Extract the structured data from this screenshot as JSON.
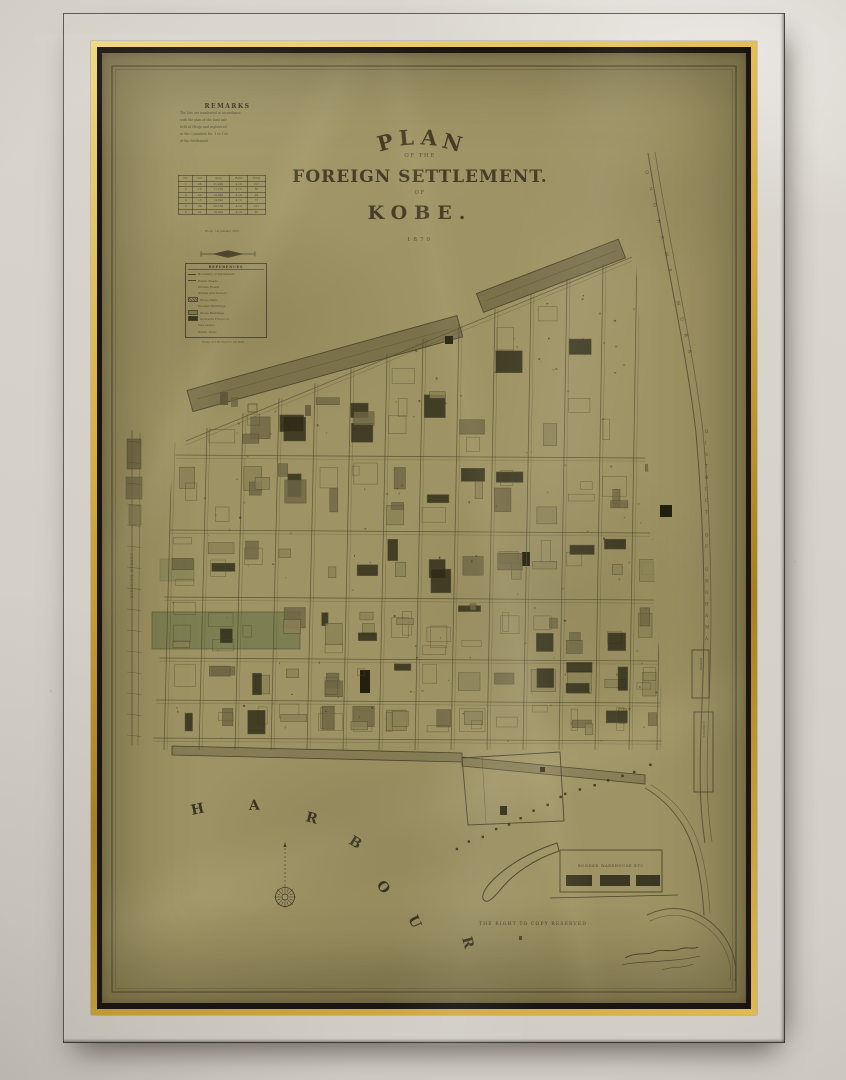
{
  "scene": {
    "wall_color": "#d8d4cc",
    "frame_color": "#46302a",
    "gold_color": "#d8ac3c",
    "paper_color": "#9e9364",
    "ink_color": "#3e3826"
  },
  "map": {
    "title": {
      "arc_letters": [
        "P",
        "L",
        "A",
        "N"
      ],
      "of_the": "OF THE",
      "main": "FOREIGN SETTLEMENT.",
      "of": "OF",
      "city": "KOBE.",
      "year": "1870"
    },
    "remarks": {
      "heading": "REMARKS",
      "lines": [
        "The lots are numbered in accordance",
        "with the plan of the land sale",
        "held at Hiogo and registered",
        "at the Consulate    No. 1 to 126",
        "of  the  Settlement"
      ]
    },
    "table": {
      "headers": [
        "No.",
        "Lot",
        "Area",
        "Rent",
        "Total"
      ],
      "rows": [
        [
          "1",
          "26",
          "21,400",
          "4.10",
          "107"
        ],
        [
          "2",
          "18",
          "17,250",
          "4.10",
          "86"
        ],
        [
          "3",
          "22",
          "19,800",
          "4.10",
          "99"
        ],
        [
          "4",
          "15",
          "14,620",
          "4.10",
          "73"
        ],
        [
          "5",
          "24",
          "20,150",
          "4.10",
          "101"
        ],
        [
          "6",
          "21",
          "18,400",
          "4.10",
          "92"
        ]
      ],
      "caption": "Hiogo, 1st January 1870"
    },
    "legend": {
      "heading": "REFERENCES",
      "rows": [
        {
          "swatch": "line",
          "label": "Boundary of Settlement"
        },
        {
          "swatch": "line",
          "label": "Public Roads"
        },
        {
          "swatch": "blank",
          "label": "Private Roads"
        },
        {
          "swatch": "blank",
          "label": "Drains and Sewers"
        },
        {
          "swatch": "hatch",
          "label": "Stone Walls"
        },
        {
          "swatch": "blank",
          "label": "Wooden Buildings"
        },
        {
          "swatch": "gray",
          "label": "Stone Buildings"
        },
        {
          "swatch": "black",
          "label": "Godowns Fireproof"
        },
        {
          "swatch": "blank",
          "label": "Gas Lamps"
        },
        {
          "swatch": "blank",
          "label": "Public Wells"
        }
      ]
    },
    "scale_note": "Scale of 160 Feet to an Inch",
    "harbour": {
      "letters": [
        "H",
        "A",
        "R",
        "B",
        "O",
        "U",
        "R"
      ]
    },
    "copy_note": "THE RIGHT TO COPY RESERVED",
    "warehouse_label": "BONDED WAREHOUSE ETC",
    "edge_labels": {
      "diagonal": "ONOHAMA MURA",
      "vertical": "DISTRICT OF ONOHAMA",
      "left": "DIVISION STREET",
      "box1": "HATOBA",
      "box2": "GODOWNS"
    }
  }
}
